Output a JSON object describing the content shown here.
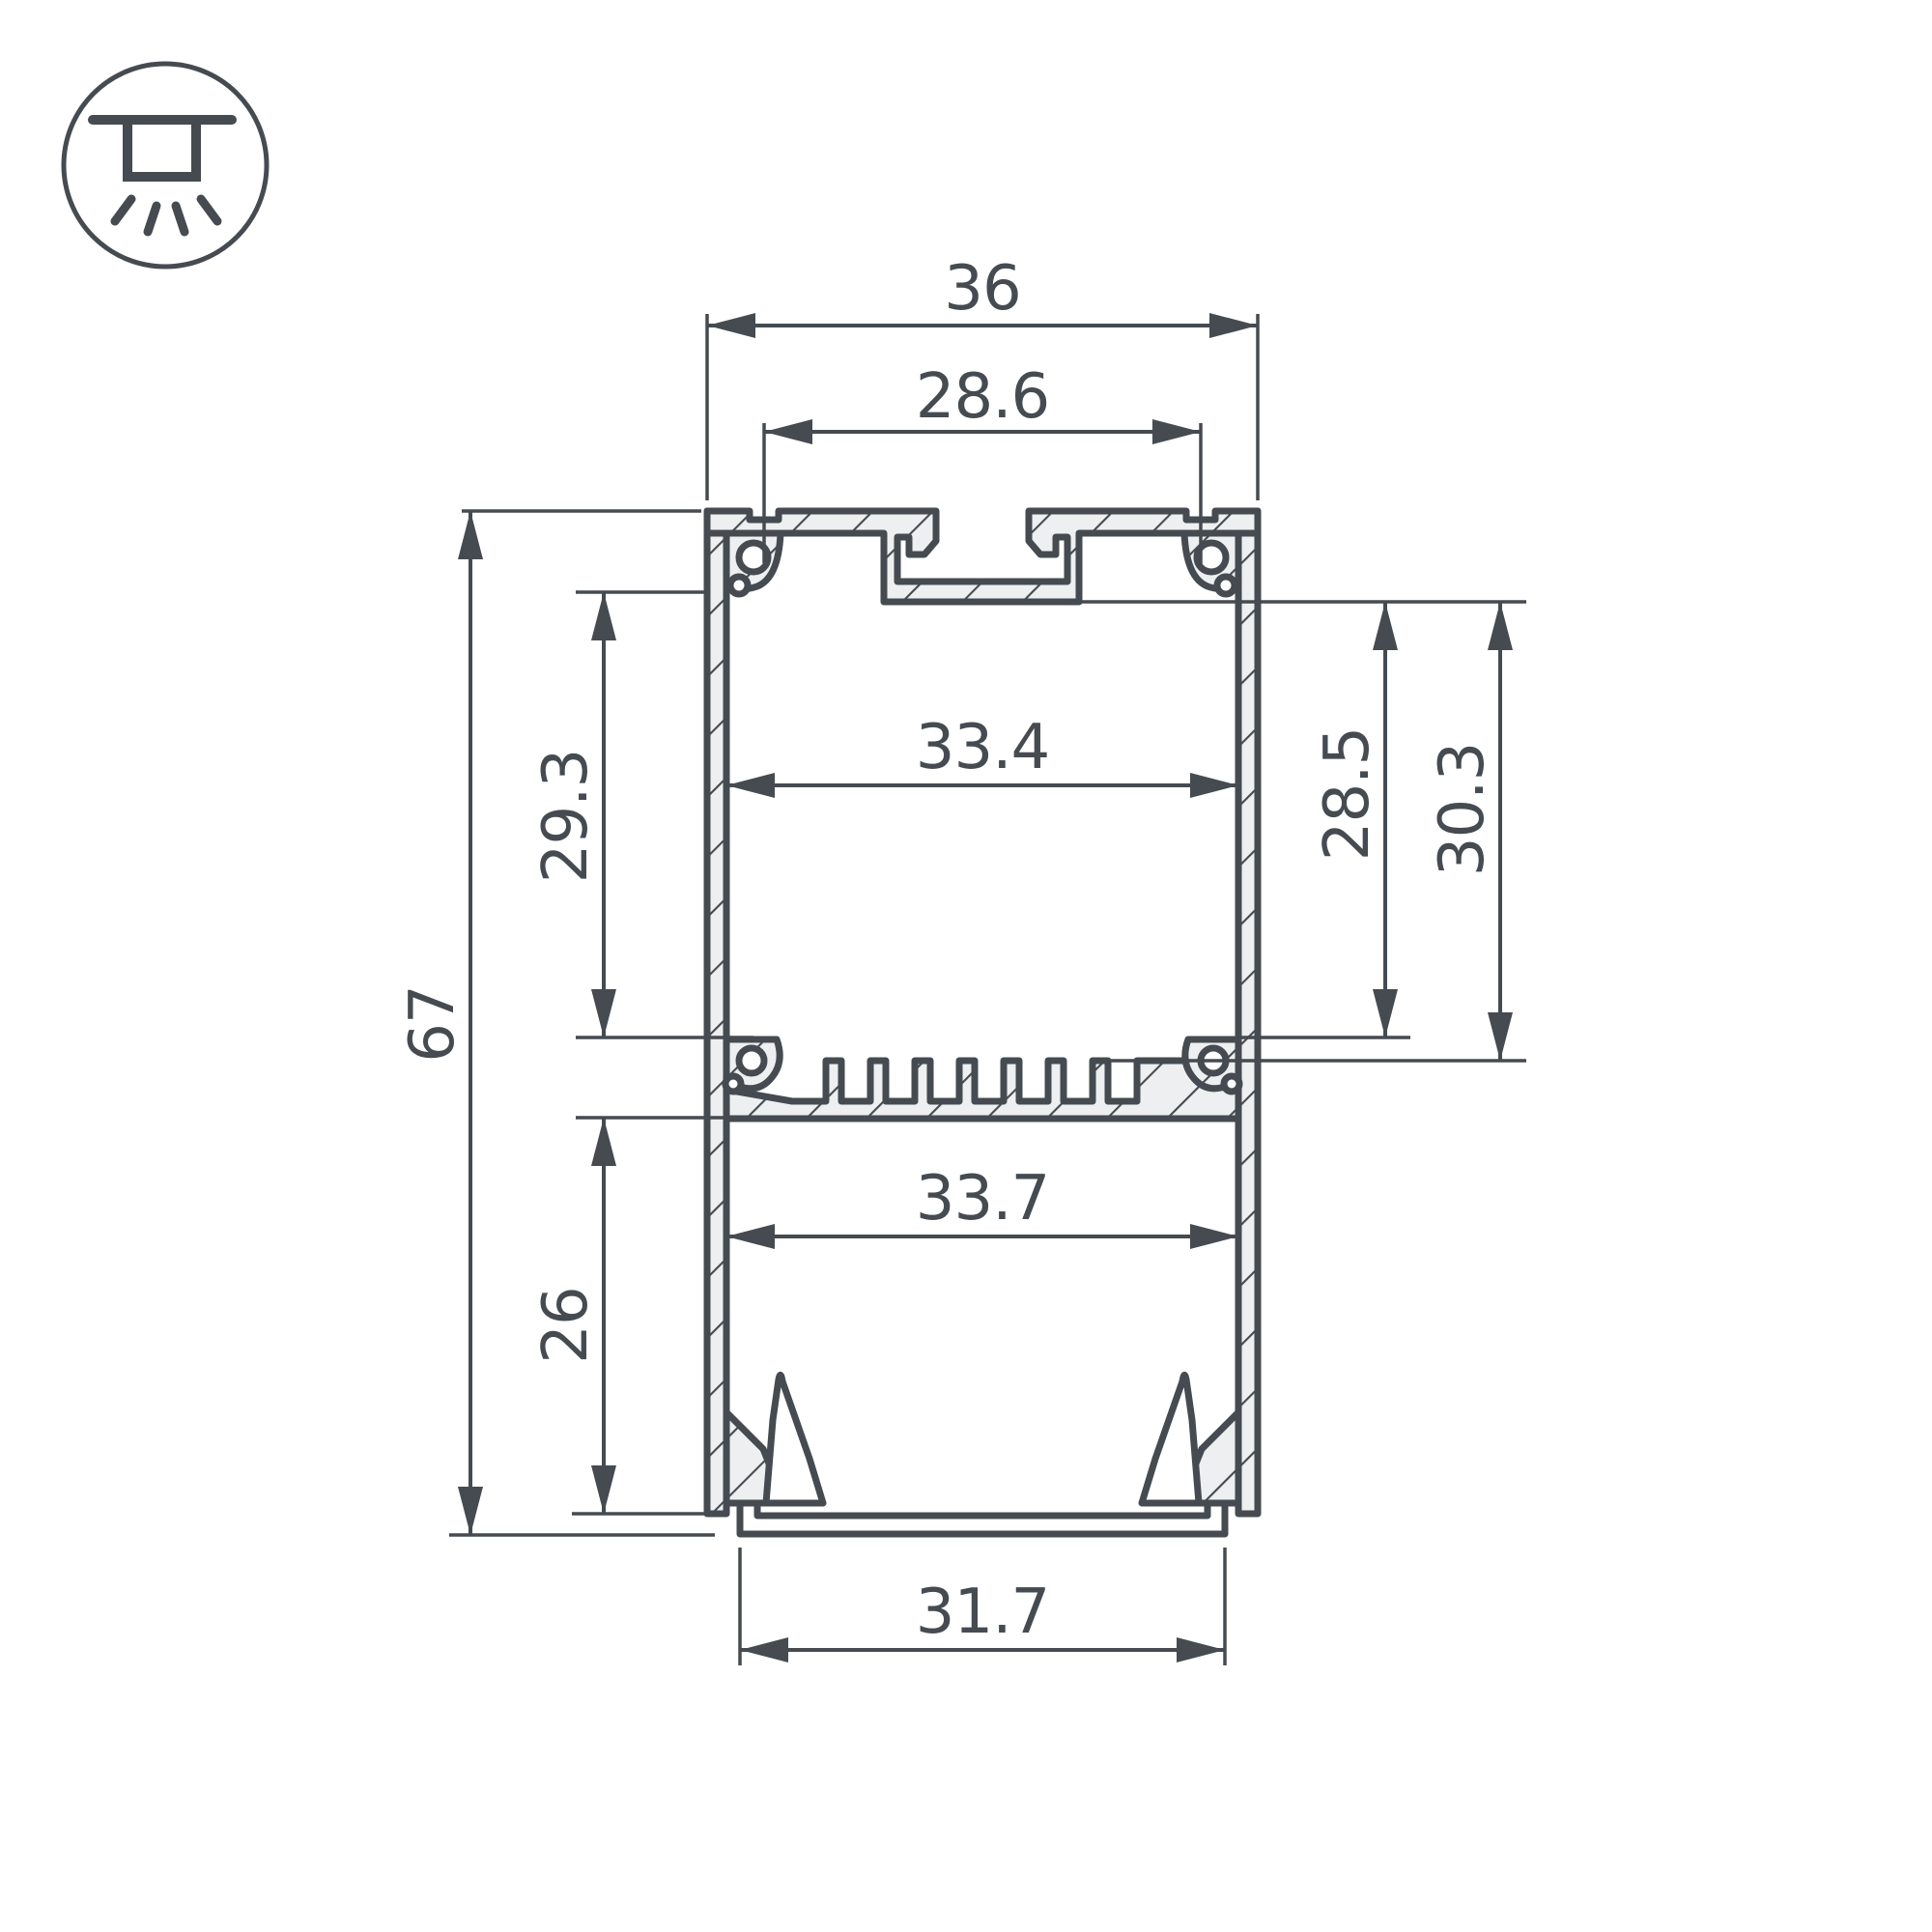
{
  "drawing": {
    "title": "led-profile-cross-section",
    "icon": {
      "name": "surface-mount-light-icon"
    },
    "dimensions": {
      "outer_width": "36",
      "mount_spacing": "28.6",
      "upper_inner_width": "33.4",
      "upper_inner_height_left": "29.3",
      "total_height": "67",
      "inner_height_right_1": "28.5",
      "inner_height_right_2": "30.3",
      "lower_inner_width": "33.7",
      "lower_inner_height": "26",
      "bottom_opening_width": "31.7"
    },
    "colors": {
      "line": "#454b51",
      "hatch_fill": "#edeff0",
      "background": "#ffffff"
    }
  }
}
